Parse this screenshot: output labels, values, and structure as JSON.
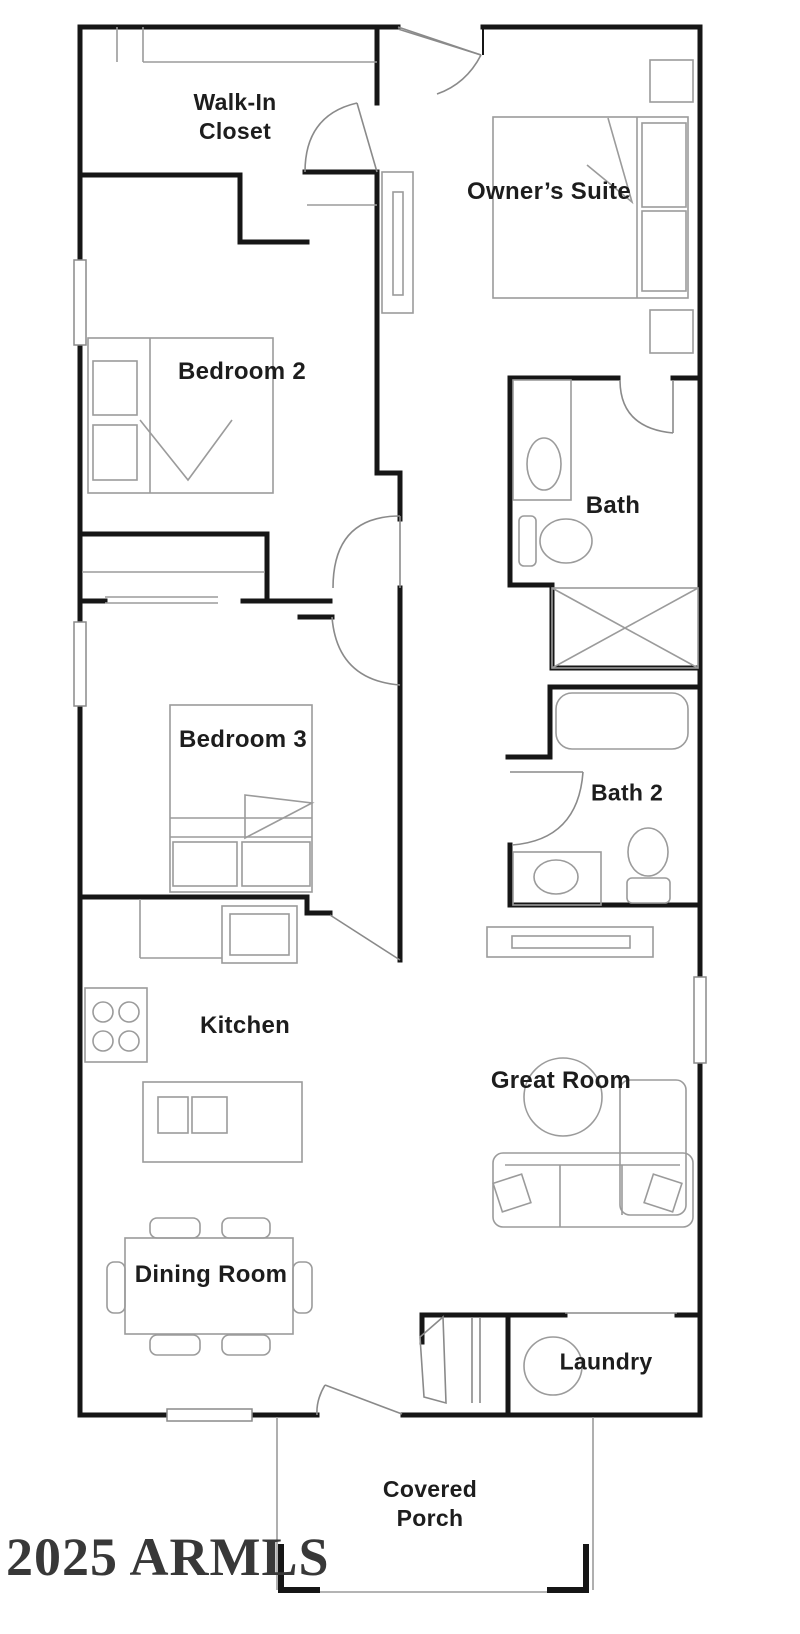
{
  "title": "Floor plan",
  "watermark": "2025 ARMLS",
  "rooms": [
    {
      "id": "walk-in-closet",
      "label": "Walk-In\nCloset"
    },
    {
      "id": "owners-suite",
      "label": "Owner’s Suite"
    },
    {
      "id": "bedroom-2",
      "label": "Bedroom 2"
    },
    {
      "id": "bath",
      "label": "Bath"
    },
    {
      "id": "bedroom-3",
      "label": "Bedroom 3"
    },
    {
      "id": "bath-2",
      "label": "Bath 2"
    },
    {
      "id": "kitchen",
      "label": "Kitchen"
    },
    {
      "id": "great-room",
      "label": "Great Room"
    },
    {
      "id": "dining-room",
      "label": "Dining Room"
    },
    {
      "id": "laundry",
      "label": "Laundry"
    },
    {
      "id": "covered-porch",
      "label": "Covered\nPorch"
    }
  ],
  "fixtures": [
    "bed-owners-suite",
    "bed-bedroom-2",
    "bed-bedroom-3",
    "nightstand",
    "dresser",
    "linen-cabinet",
    "vanity-sink-bath",
    "toilet-bath",
    "shower-bath",
    "bathtub-bath-2",
    "vanity-sink-bath-2",
    "toilet-bath-2",
    "hall-cabinet",
    "stove-cooktop",
    "refrigerator",
    "kitchen-island-sink",
    "dining-table",
    "dining-chairs",
    "sofa-sectional",
    "round-table",
    "washer",
    "window",
    "door-swing",
    "porch-column"
  ],
  "colors": {
    "wall": "#161616",
    "furniture": "#9b9b9b",
    "door": "#8a8a8a",
    "label": "#1d1d1d",
    "watermark": "#383838",
    "background": "#ffffff"
  }
}
